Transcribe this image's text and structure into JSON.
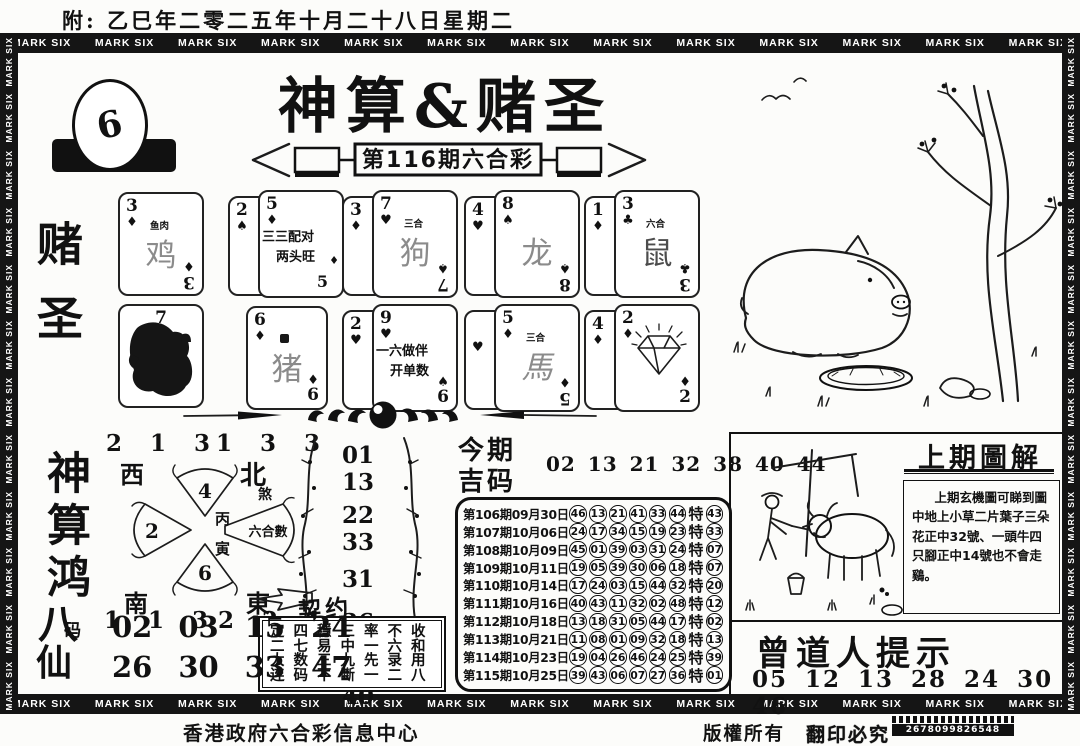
{
  "page": {
    "top_note": "附: 乙巳年二零二五年十月二十八日星期二",
    "banner_word": "MARK SIX",
    "footer_left": "香港政府六合彩信息中心",
    "footer_right1": "版權所有",
    "footer_right2": "翻印必究",
    "footer_code": "2678099826548"
  },
  "header": {
    "title": "神算&赌圣",
    "issue": "第116期六合彩",
    "logo_number": "6",
    "side_label": "赌圣"
  },
  "cards": {
    "r1c1": {
      "rank": "3",
      "suit": "♦",
      "tag": "鱼肉",
      "zodiac": "鸡",
      "bottom_rank": "3",
      "bottom_suit": "♦"
    },
    "r1c2": {
      "back_rank": "2",
      "back_suit": "♠",
      "rank": "5",
      "suit": "♦",
      "line1": "三三配对",
      "line2": "两头旺",
      "bottom_num": "5",
      "side_suit": "♦"
    },
    "r1c3": {
      "back_rank": "3",
      "back_suit": "♦",
      "rank": "7",
      "suit": "♥",
      "tag": "三合",
      "zodiac": "狗",
      "bottom_rank": "7",
      "bottom_suit": "♠"
    },
    "r1c4": {
      "back_rank": "4",
      "back_suit": "♥",
      "rank": "8",
      "suit": "♠",
      "zodiac": "龙",
      "bottom_rank": "8",
      "bottom_suit": "♠"
    },
    "r1c5": {
      "back_rank": "1",
      "back_suit": "♦",
      "rank": "3",
      "suit": "♣",
      "tag": "六合",
      "zodiac": "鼠",
      "bottom_rank": "3",
      "bottom_suit": "♣"
    },
    "r2c1": {
      "rank": "7"
    },
    "r2c2": {
      "rank": "6",
      "suit": "♦",
      "zodiac": "猪",
      "bottom_rank": "6",
      "bottom_suit": "♦"
    },
    "r2c3": {
      "back_rank": "2",
      "back_suit": "♥",
      "rank": "9",
      "suit": "♥",
      "line1": "一六做伴",
      "line2": "开单数",
      "bottom_rank": "6",
      "bottom_suit": "♠"
    },
    "r2c4": {
      "back_suit": "♥",
      "rank": "5",
      "suit": "♦",
      "tag": "三合",
      "zodiac": "馬",
      "bottom_rank": "5",
      "bottom_suit": "♦"
    },
    "r2c5": {
      "back_rank": "4",
      "back_suit": "♦",
      "rank": "2",
      "suit": "♦",
      "bottom_rank": "2",
      "bottom_suit": "♦"
    }
  },
  "compass": {
    "nw_numbers": "2 1 3",
    "nw_label": "西",
    "ne_numbers": "1 3 3",
    "ne_label": "北",
    "ne_small": "煞",
    "sw_label": "南",
    "sw_numbers": "1 1 3",
    "se_label": "東",
    "se_numbers": "2 2 1",
    "blade_top": "4",
    "blade_left": "2",
    "blade_bottom": "6",
    "blade_right": "六合數",
    "center_top": "丙",
    "center_bottom": "寅"
  },
  "plum_numbers": [
    "01 13",
    "22 33",
    "31",
    "36",
    "37",
    "40"
  ],
  "contract": {
    "label": "契约",
    "rows": [
      "定四穩三率不收",
      "二七易中一六和",
      "大数三九先录用",
      "连码不斷一二八"
    ]
  },
  "lucky": {
    "title_line1": "今期",
    "title_line2": "吉码",
    "numbers": "02 13 21 32 38 40 44"
  },
  "results": {
    "special_prefix": "特",
    "rows": [
      {
        "label": "第106期09月30日",
        "nums": [
          "46",
          "13",
          "21",
          "41",
          "33",
          "44"
        ],
        "special": "43"
      },
      {
        "label": "第107期10月06日",
        "nums": [
          "24",
          "17",
          "34",
          "15",
          "19",
          "23"
        ],
        "special": "33"
      },
      {
        "label": "第108期10月09日",
        "nums": [
          "45",
          "01",
          "39",
          "03",
          "31",
          "24"
        ],
        "special": "07"
      },
      {
        "label": "第109期10月11日",
        "nums": [
          "19",
          "05",
          "39",
          "30",
          "06",
          "18"
        ],
        "special": "07"
      },
      {
        "label": "第110期10月14日",
        "nums": [
          "17",
          "24",
          "03",
          "15",
          "44",
          "32"
        ],
        "special": "20"
      },
      {
        "label": "第111期10月16日",
        "nums": [
          "40",
          "43",
          "11",
          "32",
          "02",
          "48"
        ],
        "special": "12"
      },
      {
        "label": "第112期10月18日",
        "nums": [
          "13",
          "18",
          "31",
          "05",
          "44",
          "17"
        ],
        "special": "02"
      },
      {
        "label": "第113期10月21日",
        "nums": [
          "11",
          "08",
          "01",
          "09",
          "32",
          "18"
        ],
        "special": "13"
      },
      {
        "label": "第114期10月23日",
        "nums": [
          "19",
          "04",
          "26",
          "46",
          "24",
          "25"
        ],
        "special": "39"
      },
      {
        "label": "第115期10月25日",
        "nums": [
          "39",
          "43",
          "06",
          "07",
          "27",
          "36"
        ],
        "special": "01"
      }
    ]
  },
  "left_panel": {
    "seal": "神算鸿",
    "bama_1": "八",
    "bama_2": "码",
    "bama_3": "仙",
    "row1": [
      "02",
      "03",
      "15",
      "24"
    ],
    "row2": [
      "26",
      "30",
      "33",
      "47"
    ]
  },
  "last_issue": {
    "title": "上期圖解",
    "body": "上期玄機圖可睇到圖中地上小草二片葉子三朵花正中32號、一頭牛四只腳正中14號也不會走鷄。"
  },
  "tips": {
    "title": "曾道人提示",
    "numbers": "05 12 13 28 24 30 46"
  }
}
